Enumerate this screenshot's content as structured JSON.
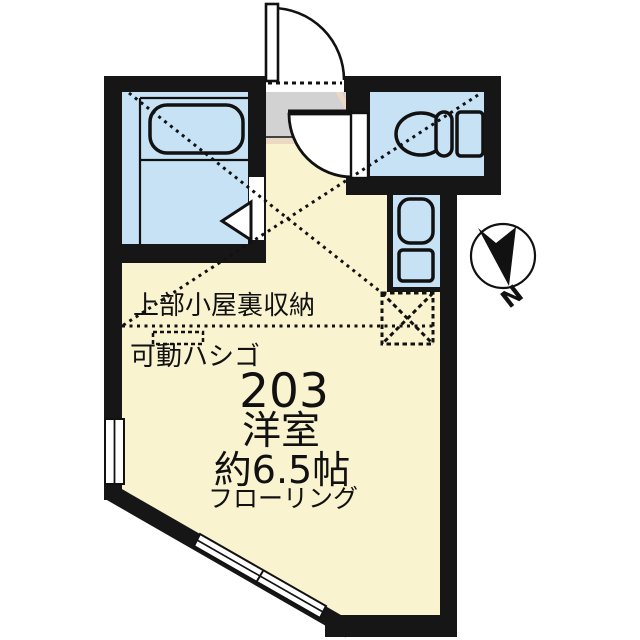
{
  "floor_plan": {
    "labels": {
      "attic_storage": "上部小屋裏収納",
      "movable_ladder": "可動ハシゴ",
      "room_number": "203",
      "room_type": "洋室",
      "room_size": "約6.5帖",
      "flooring": "フローリング",
      "compass_north": "N"
    },
    "rooms": [
      {
        "name": "main-room",
        "label": "洋室 約6.5帖 フローリング",
        "floor_color": "#faf3d0"
      },
      {
        "name": "bathroom",
        "fixture": "bathtub",
        "floor_color": "#c7e2f4"
      },
      {
        "name": "toilet-room",
        "fixture": "toilet",
        "floor_color": "#c7e2f4"
      },
      {
        "name": "entrance-genkan",
        "floor_color": "#d2d2d2"
      },
      {
        "name": "kitchen-alcove",
        "fixtures": "sink-and-stove",
        "floor_color": "#c7e2f4"
      }
    ],
    "colors": {
      "wall": "#161616",
      "room_floor": "#faf3d0",
      "wet_area": "#c7e2f4",
      "genkan": "#d2d2d2",
      "step_trim": "#ecd9c4",
      "line": "#111111",
      "background": "#ffffff"
    }
  }
}
